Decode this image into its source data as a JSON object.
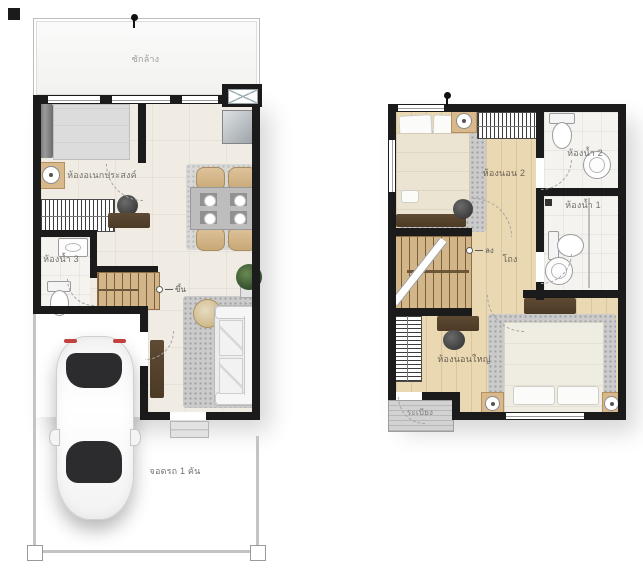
{
  "floor1": {
    "labels": {
      "laundry": "ซักล้าง",
      "multipurpose_room": "ห้องอเนกประสงค์",
      "bathroom3": "ห้องน้ำ 3",
      "stairs_up": "ขึ้น",
      "parking": "จอดรถ 1 คัน"
    }
  },
  "floor2": {
    "labels": {
      "bedroom2": "ห้องนอน 2",
      "bathroom2": "ห้องน้ำ 2",
      "bathroom1": "ห้องน้ำ 1",
      "hall": "โถง",
      "master_bedroom": "ห้องนอนใหญ่",
      "balcony": "ระเบียง",
      "stairs_down": "ลง"
    }
  },
  "colors": {
    "wall": "#1b1b1b",
    "tile_floor": "#f0ece3",
    "wood_floor": "#ead8b2",
    "bathroom_tile": "#f4f3f0",
    "stairs_wood": "#d2b68a",
    "rug_gray": "#cbcbcb",
    "furniture_dark_wood": "#54412d",
    "chair_tan": "#d2b386",
    "deck_gray": "#d2d2d2",
    "car_glass": "#2c2c2e",
    "label_text": "#71716d"
  }
}
